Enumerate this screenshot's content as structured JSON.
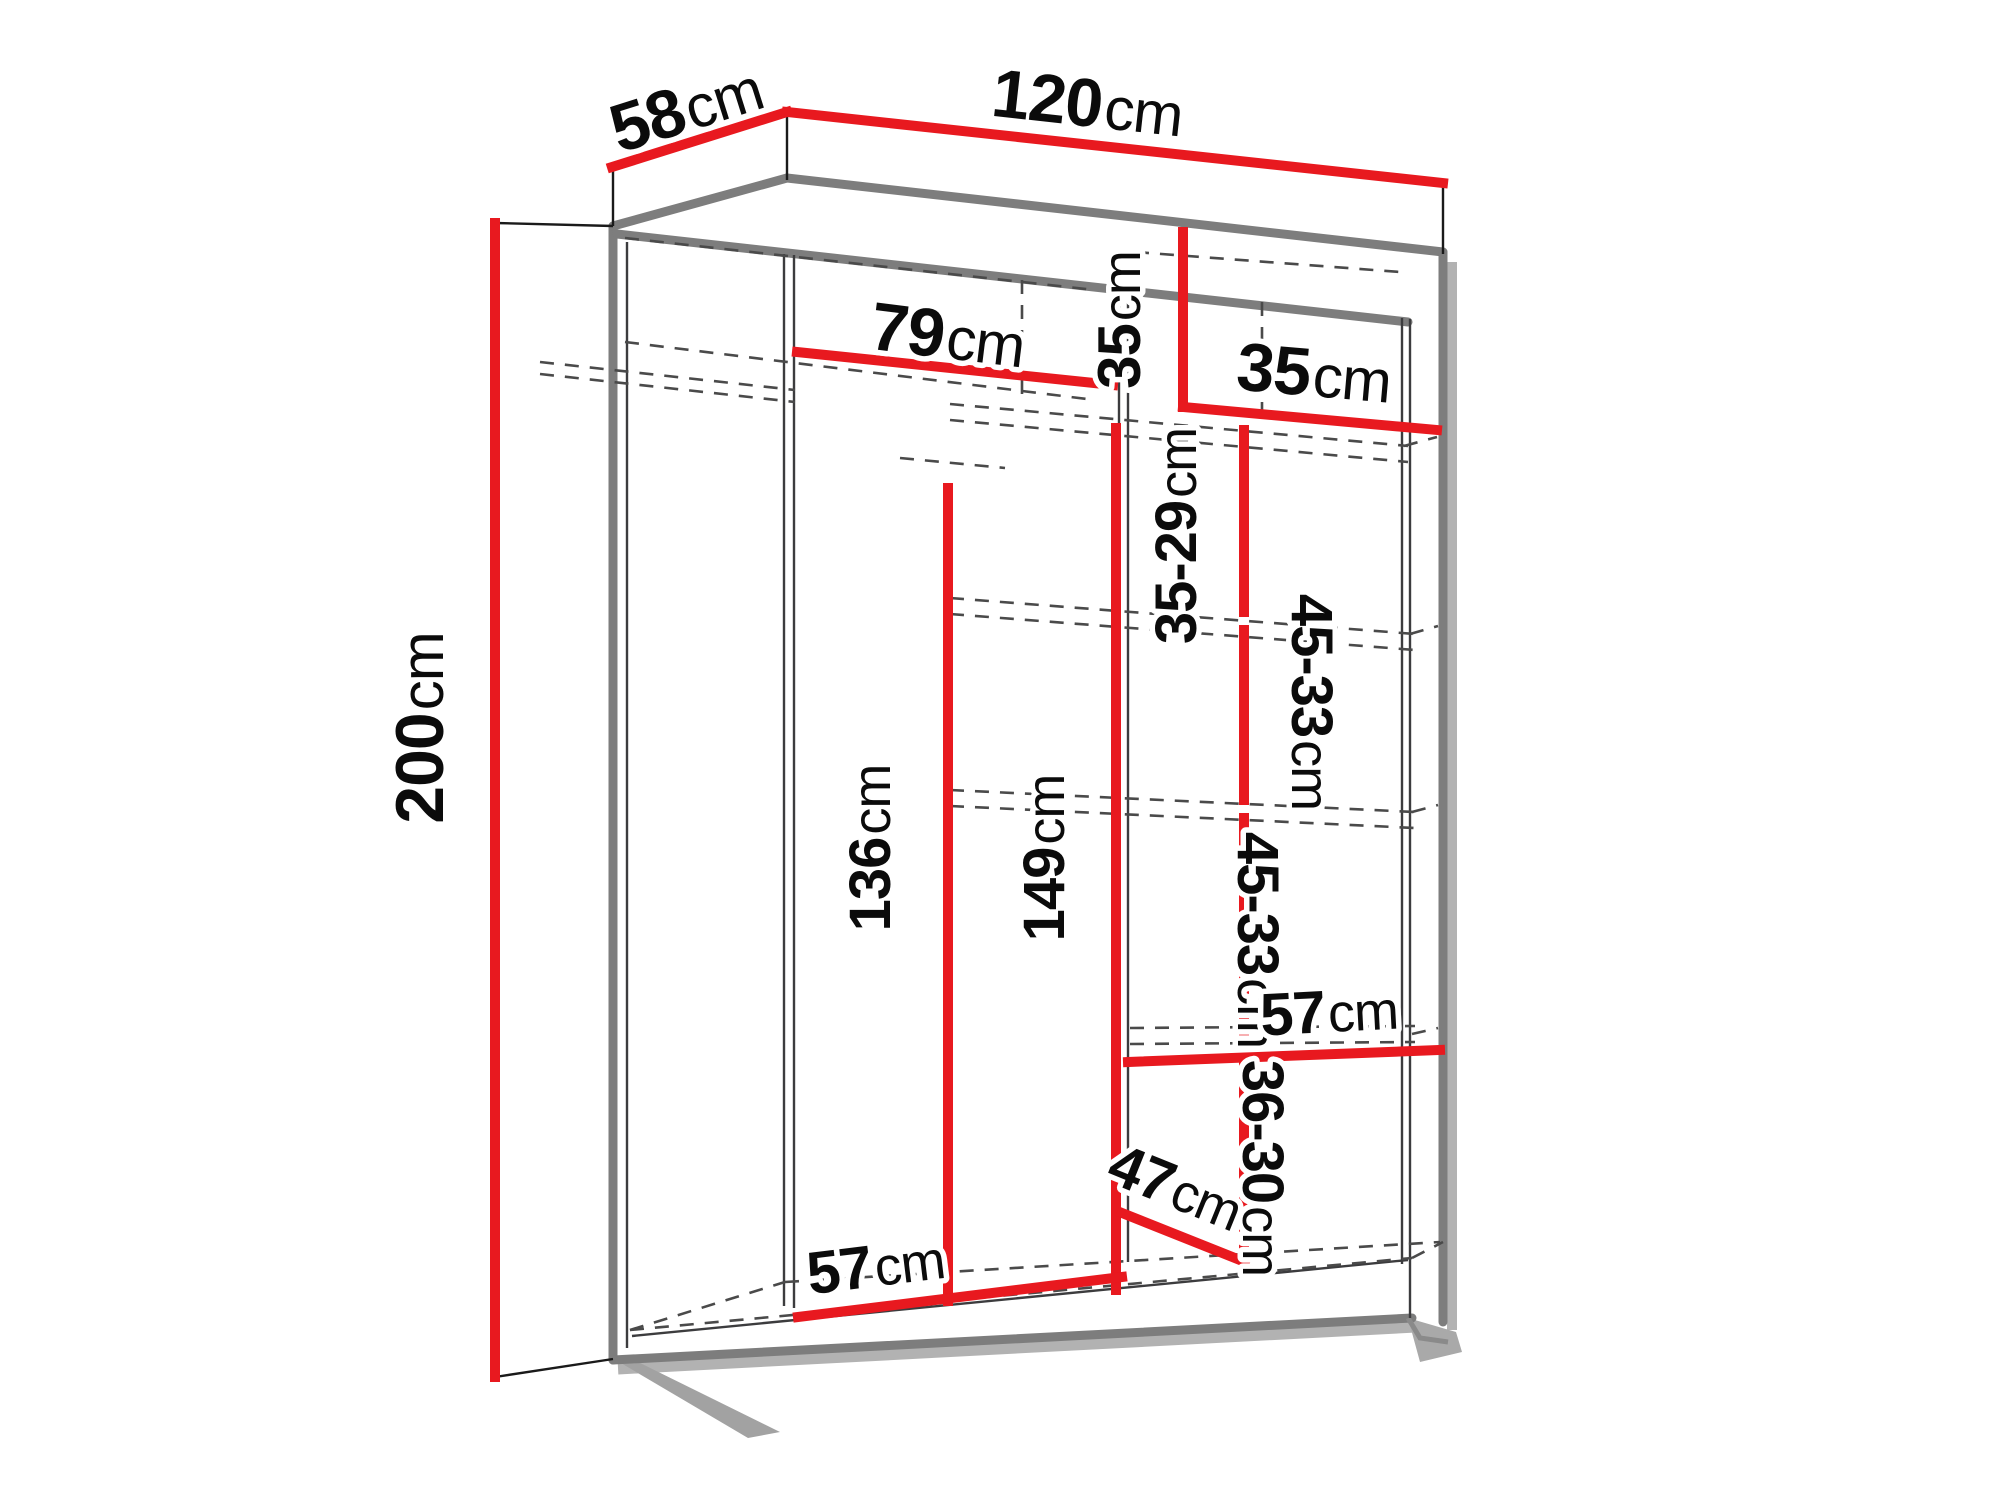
{
  "diagram": {
    "kind": "wardrobe-dimension-drawing",
    "unit": "cm",
    "accent_color": "#e8191f",
    "outline_color": "#7d7d7d"
  },
  "labels": {
    "depth": {
      "value": "58",
      "unit": "cm"
    },
    "width": {
      "value": "120",
      "unit": "cm"
    },
    "height": {
      "value": "200",
      "unit": "cm"
    },
    "left_section_width": {
      "value": "79",
      "unit": "cm"
    },
    "cubby_height": {
      "value": "35",
      "unit": "cm"
    },
    "cubby_width": {
      "value": "35",
      "unit": "cm"
    },
    "shelf_gap_top": {
      "value": "35-29",
      "unit": "cm"
    },
    "shelf_gap_upper": {
      "value": "45-33",
      "unit": "cm"
    },
    "shelf_gap_lower": {
      "value": "45-33",
      "unit": "cm"
    },
    "rod_clearance": {
      "value": "136",
      "unit": "cm"
    },
    "column_height": {
      "value": "149",
      "unit": "cm"
    },
    "right_shelf_width": {
      "value": "57",
      "unit": "cm"
    },
    "bottom_gap": {
      "value": "36-30",
      "unit": "cm"
    },
    "bottom_depth": {
      "value": "47",
      "unit": "cm"
    },
    "bottom_left_width": {
      "value": "57",
      "unit": "cm"
    }
  }
}
